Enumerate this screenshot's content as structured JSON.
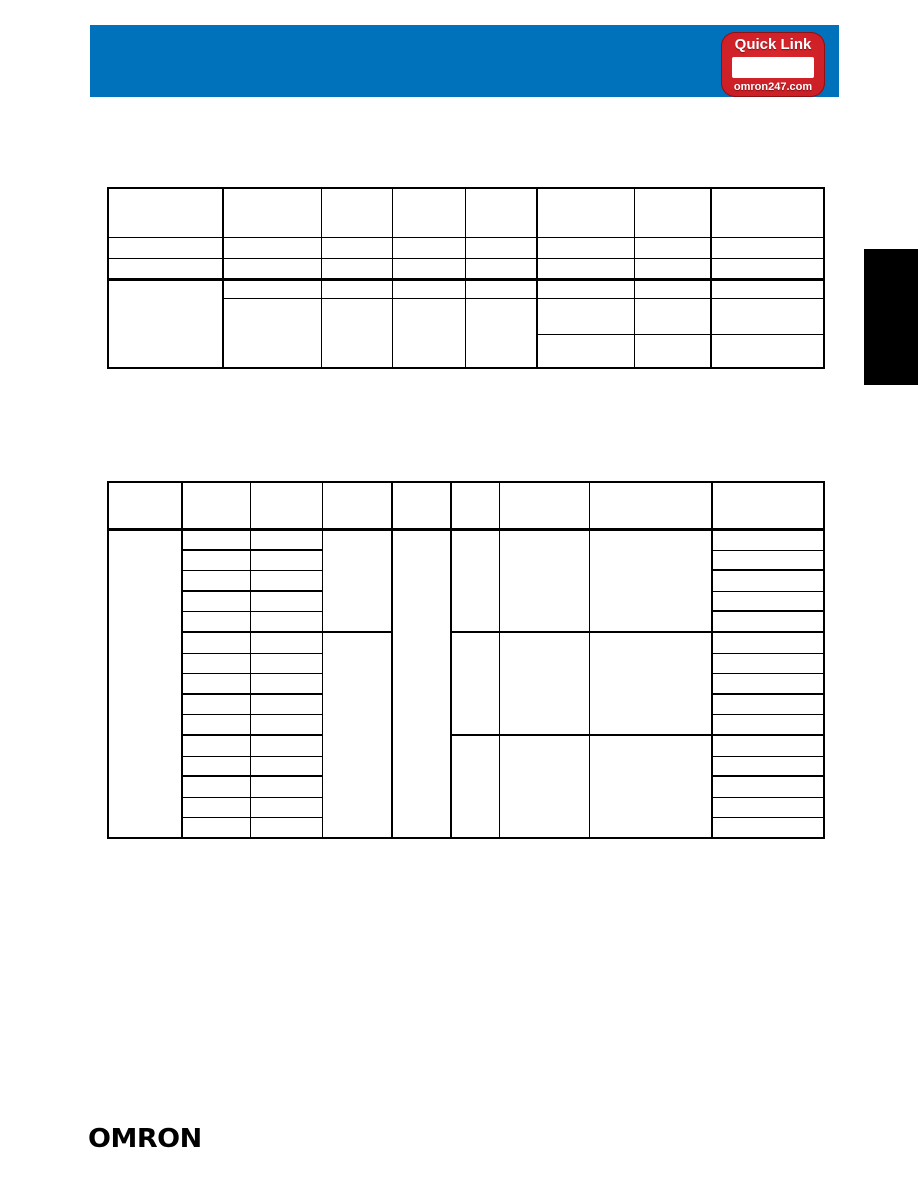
{
  "header_bar": {
    "color": "#0072BC"
  },
  "quick_link_badge": {
    "title": "Quick Link",
    "url_label": "omron247.com",
    "red": "#CB1E25",
    "red_dark": "#9E1419",
    "text_color": "#FFFFFF",
    "link_box_color": "#FFFFFF"
  },
  "side_tab": {
    "color": "#000000"
  },
  "logo": {
    "text": "OMRON",
    "color": "#000000"
  },
  "tables": {
    "specifications_grid": {
      "columns": 8,
      "header_rows": 1,
      "body_rows": 5,
      "cells_text": ""
    },
    "ordering_grid": {
      "columns": 9,
      "header_rows": 1,
      "body_rows": 15,
      "cells_text": ""
    }
  }
}
